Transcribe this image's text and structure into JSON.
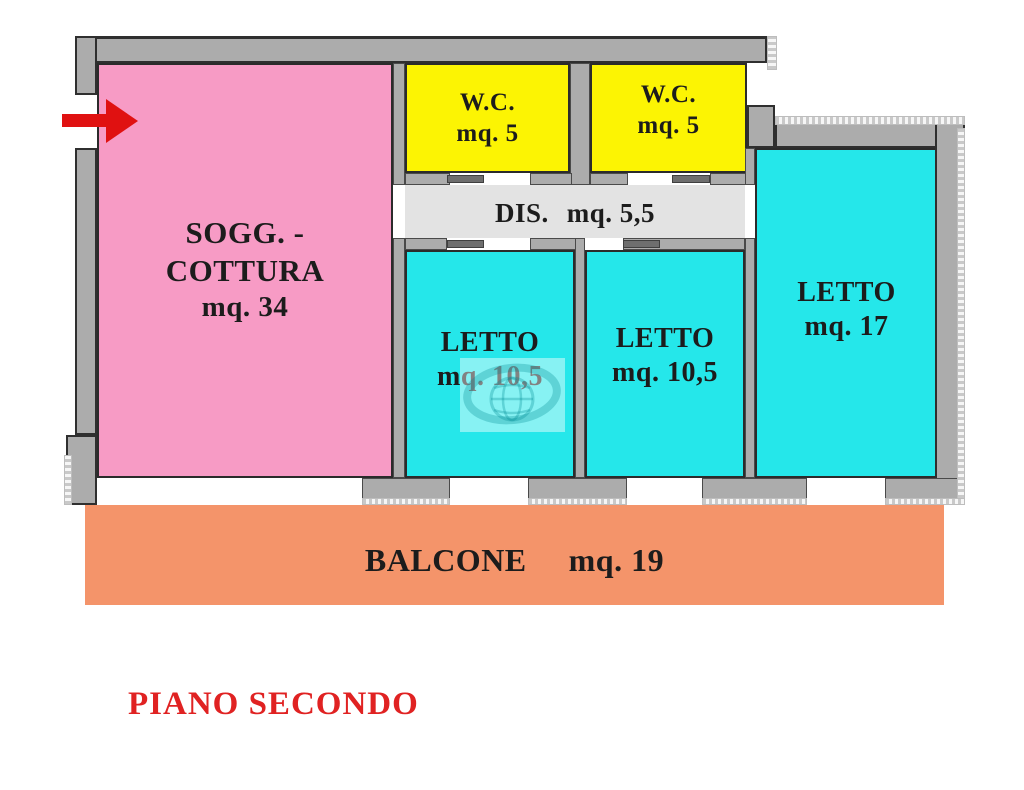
{
  "title": "PIANO SECONDO",
  "rooms": {
    "soggiorno": {
      "line1": "SOGG. -",
      "line2": "COTTURA",
      "area": "mq. 34"
    },
    "wc_left": {
      "name": "W.C.",
      "area": "mq. 5"
    },
    "wc_right": {
      "name": "W.C.",
      "area": "mq. 5"
    },
    "disimpegno": {
      "name": "DIS.",
      "area": "mq. 5,5"
    },
    "letto_left": {
      "name": "LETTO",
      "area": "mq. 10,5"
    },
    "letto_center": {
      "name": "LETTO",
      "area": "mq. 10,5"
    },
    "letto_right": {
      "name": "LETTO",
      "area": "mq. 17"
    },
    "balcone": {
      "name": "BALCONE",
      "area": "mq. 19"
    }
  },
  "colors": {
    "room-pink": "#F79BC5",
    "room-yellow": "#FCF403",
    "room-cyan": "#25E7EA",
    "corridor-gray": "#E3E3E3",
    "balcony-orange": "#F4946A",
    "wall-gray": "#ACACAC",
    "door-gray": "#6E6E6E",
    "arrow-red": "#E01111",
    "title-red": "#E02222",
    "label-dark": "#1C1C1C"
  }
}
